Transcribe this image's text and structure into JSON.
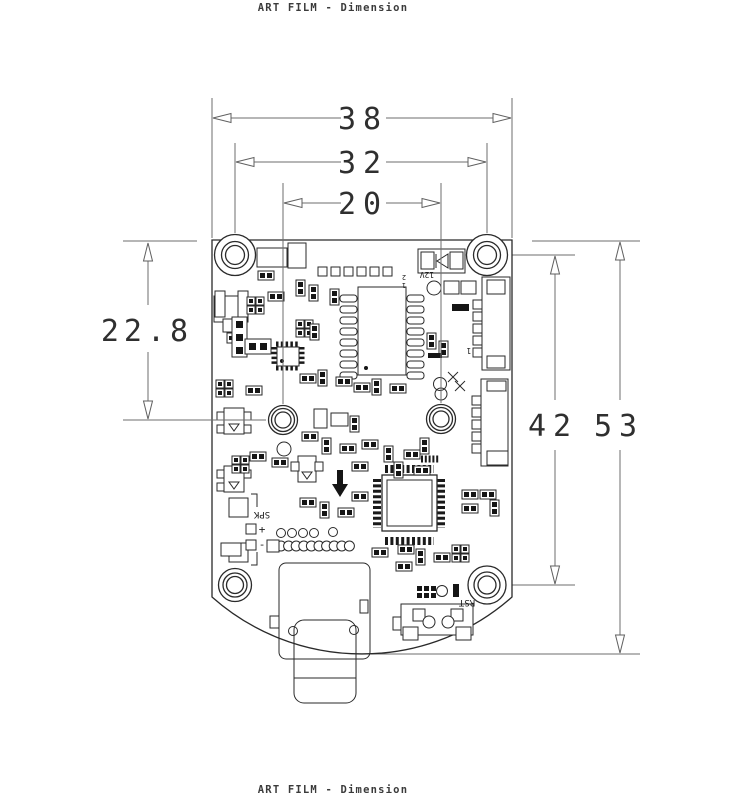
{
  "titles": {
    "top": "ART FILM - Dimension",
    "bottom": "ART FILM - Dimension"
  },
  "dimensions": {
    "board_width": "38",
    "top_hole_span": "32",
    "mid_hole_span": "20",
    "top_edge_to_mid_holes": "22.8",
    "hole_column_span": "42",
    "board_height": "53"
  },
  "silkscreen": {
    "power_label": "12V",
    "pin2_label": "2",
    "pin1_label": "1",
    "connector_pin1_label": "1",
    "speaker_label": "SPK",
    "speaker_plus": "+",
    "speaker_minus": "-",
    "reset_label": "RST"
  },
  "colors": {
    "line_ink": "#2a2a2a",
    "dimension_gray": "#6e6e6e",
    "pad_fill": "#151515",
    "background": "#ffffff"
  }
}
